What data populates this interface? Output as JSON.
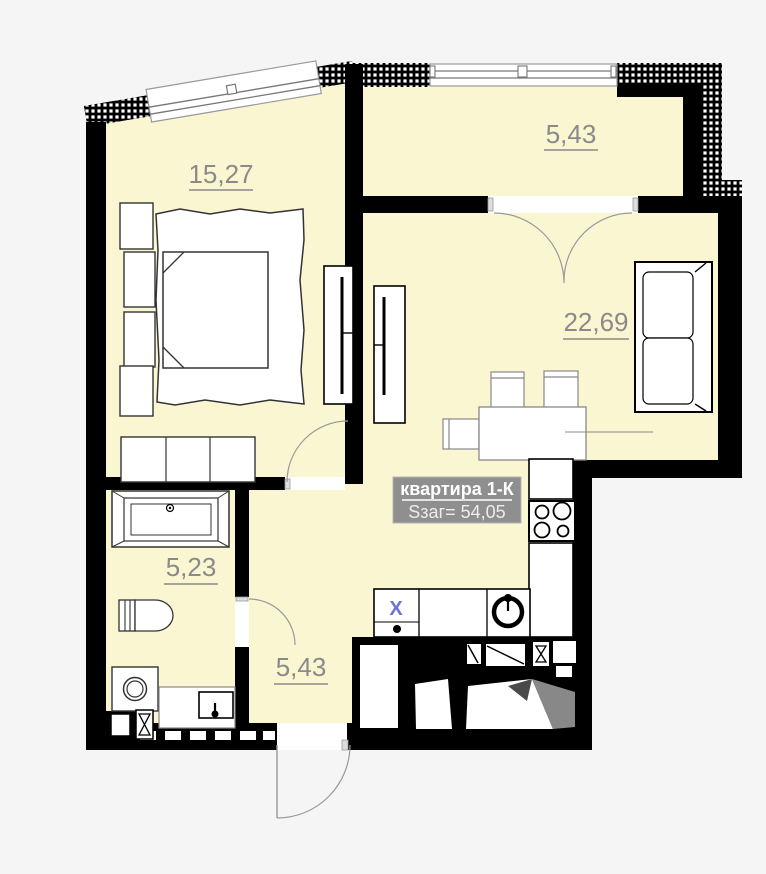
{
  "plan": {
    "apartment": {
      "title": "квартира 1-К",
      "total_area": "Sзаг= 54,05"
    },
    "rooms": [
      {
        "id": "bedroom",
        "area": "15,27"
      },
      {
        "id": "loggia",
        "area": "5,43"
      },
      {
        "id": "living-kitchen",
        "area": "22,69"
      },
      {
        "id": "bathroom",
        "area": "5,23"
      },
      {
        "id": "hallway",
        "area": "5,43"
      }
    ],
    "markers": {
      "appliance": "X"
    },
    "colors": {
      "background": "#f5f5f5",
      "floor": "#faf6d2",
      "wall": "#000000",
      "area_text": "#8a8a8a",
      "label_bg": "#8f8f8f",
      "label_text": "#ffffff",
      "label_subtext": "#ededed",
      "marker_x": "#6f6fd8",
      "stair_shadow": "#888888"
    }
  }
}
